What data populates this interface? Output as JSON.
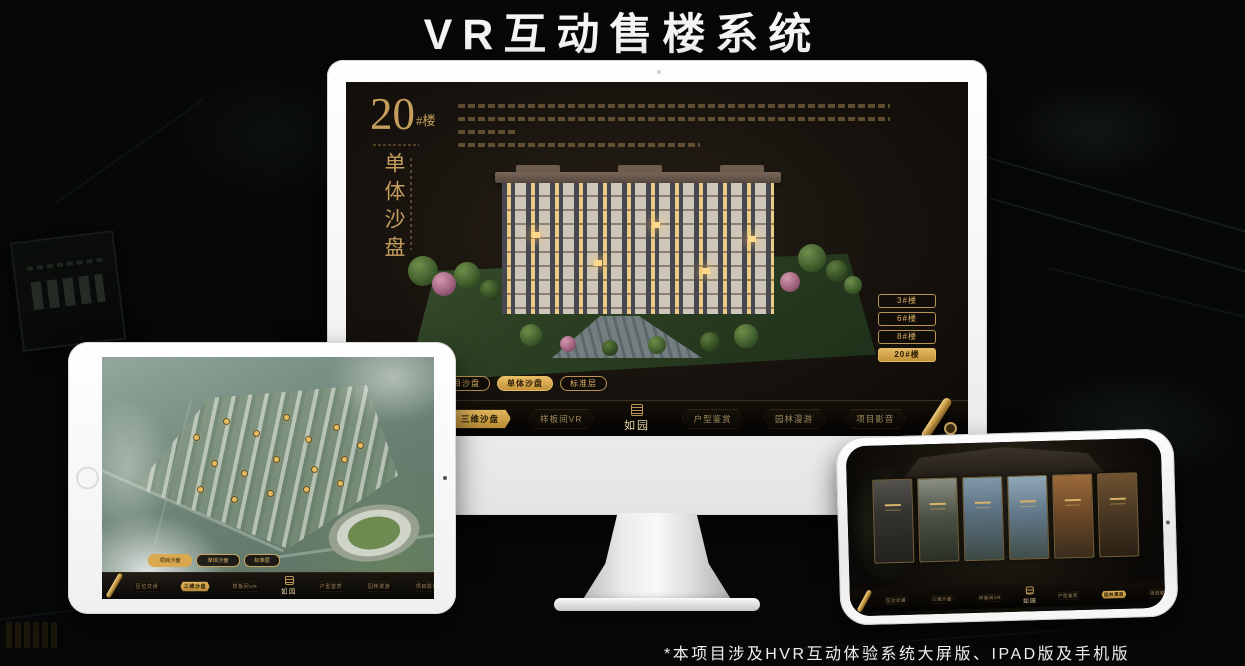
{
  "header": {
    "title": "VR互动售楼系统"
  },
  "footnote": "*本项目涉及HVR互动体验系统大屏版、IPAD版及手机版",
  "colors": {
    "accent_gold": "#c9a360",
    "active_gold": "#d9a94f",
    "screen_bg": "#17120d"
  },
  "monitor": {
    "building_title": {
      "number": "20",
      "suffix": "#楼",
      "subtitle": "单体沙盘"
    },
    "floor_buttons": [
      {
        "label": "3#楼",
        "active": false
      },
      {
        "label": "6#楼",
        "active": false
      },
      {
        "label": "8#楼",
        "active": false
      },
      {
        "label": "20#楼",
        "active": true
      }
    ],
    "view_tabs": [
      {
        "label": "项目沙盘",
        "active": false
      },
      {
        "label": "单体沙盘",
        "active": true
      },
      {
        "label": "标准层",
        "active": false
      }
    ],
    "nav": {
      "logo": "如园",
      "items": [
        {
          "label": "区位交通",
          "active": false
        },
        {
          "label": "三维沙盘",
          "active": true
        },
        {
          "label": "样板间VR",
          "active": false
        },
        {
          "label": "户型鉴赏",
          "active": false
        },
        {
          "label": "园林漫游",
          "active": false
        },
        {
          "label": "项目影音",
          "active": false
        }
      ]
    }
  },
  "tablet": {
    "view_tabs": [
      {
        "label": "项目沙盘",
        "active": true
      },
      {
        "label": "单体沙盘",
        "active": false
      },
      {
        "label": "标准层",
        "active": false
      }
    ],
    "nav": {
      "logo": "如园",
      "items": [
        {
          "label": "区位交通",
          "active": false
        },
        {
          "label": "三维沙盘",
          "active": true
        },
        {
          "label": "样板间VR",
          "active": false
        },
        {
          "label": "户型鉴赏",
          "active": false
        },
        {
          "label": "园林漫游",
          "active": false
        },
        {
          "label": "项目影音",
          "active": false
        }
      ]
    }
  },
  "phone": {
    "nav": {
      "logo": "如园",
      "items": [
        {
          "label": "区位交通",
          "active": false
        },
        {
          "label": "三维沙盘",
          "active": false
        },
        {
          "label": "样板间VR",
          "active": false
        },
        {
          "label": "户型鉴赏",
          "active": false
        },
        {
          "label": "园林漫游",
          "active": true
        },
        {
          "label": "项目影音",
          "active": false
        }
      ]
    }
  }
}
